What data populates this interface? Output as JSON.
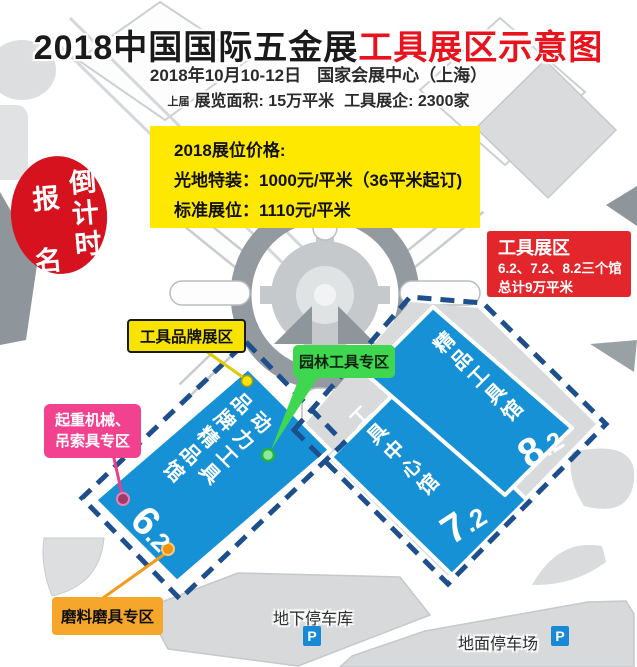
{
  "title": {
    "black": "2018中国国际五金展",
    "red": "工具展区示意图"
  },
  "subtitle": {
    "date": "2018年10月10-12日",
    "venue": "国家会展中心（上海）"
  },
  "stats": {
    "prefix": "上届",
    "area": "展览面积: 15万平米",
    "count": "工具展企: 2300家"
  },
  "price_box": {
    "line1": "2018展位价格:",
    "line2": "光地特装：1000元/平米（36平米起订)",
    "line3": "标准展位：1110元/平米"
  },
  "countdown_badge": {
    "left_top": "报",
    "left_bottom": "名",
    "right_column": "倒计时"
  },
  "zone_box": {
    "title": "工具展区",
    "line2": "6.2、7.2、8.2三个馆",
    "line3": "总计9万平米"
  },
  "labels": {
    "brand": "工具品牌展区",
    "garden": "园林工具专区",
    "lifting_line1": "起重机械、",
    "lifting_line2": "吊索具专区",
    "abrasives": "磨料磨具专区"
  },
  "halls": [
    {
      "name": "动力工具\n品牌精品馆",
      "num_major": "6",
      "num_minor": ".2"
    },
    {
      "name": "工具中心馆",
      "num_major": "7",
      "num_minor": ".2"
    },
    {
      "name": "精品工具馆",
      "num_major": "8",
      "num_minor": ".2"
    }
  ],
  "parking": {
    "underground": "地下停车库",
    "ground": "地面停车场",
    "p_label": "P"
  },
  "colors": {
    "hall_blue": "#1691d6",
    "dashed_border_navy": "#1d4f8c",
    "price_yellow": "#ffe800",
    "label_yellow": "#f8e400",
    "label_green": "#3fd74f",
    "label_pink": "#f2418f",
    "label_orange": "#f5a62b",
    "zone_red": "#e2262c",
    "badge_red": "#d5121e",
    "title_red": "#e8131d"
  }
}
